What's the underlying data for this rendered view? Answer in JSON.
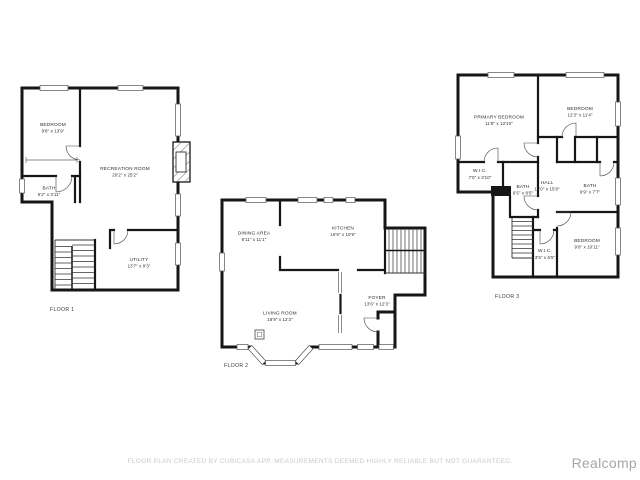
{
  "floors": [
    {
      "label": "FLOOR 1",
      "rooms": [
        {
          "name": "BEDROOM",
          "dims": "9'8\" x 13'9\""
        },
        {
          "name": "RECREATION ROOM",
          "dims": "20'2\" x 25'2\""
        },
        {
          "name": "BATH",
          "dims": "6'2\" x 3'11\""
        },
        {
          "name": "UTILITY",
          "dims": "13'7\" x 9'3\""
        }
      ]
    },
    {
      "label": "FLOOR 2",
      "rooms": [
        {
          "name": "DINING AREA",
          "dims": "8'11\" x 11'1\""
        },
        {
          "name": "KITCHEN",
          "dims": "16'9\" x 10'9\""
        },
        {
          "name": "FOYER",
          "dims": "13'6\" x 12'3\""
        },
        {
          "name": "LIVING ROOM",
          "dims": "18'9\" x 12'3\""
        }
      ]
    },
    {
      "label": "FLOOR 3",
      "rooms": [
        {
          "name": "PRIMARY BEDROOM",
          "dims": "11'8\" x 13'10\""
        },
        {
          "name": "BEDROOM",
          "dims": "12'3\" x 11'4\""
        },
        {
          "name": "W.I.C.",
          "dims": "7'0\" x 3'10\""
        },
        {
          "name": "BATH",
          "dims": "6'5\" x 8'5\""
        },
        {
          "name": "HALL",
          "dims": "10'0\" x 15'8\""
        },
        {
          "name": "BATH",
          "dims": "9'9\" x 7'7\""
        },
        {
          "name": "BEDROOM",
          "dims": "9'9\" x 10'11\""
        },
        {
          "name": "W.I.C.",
          "dims": "3'5\" x 6'5\""
        }
      ]
    }
  ],
  "footer": {
    "disclaimer": "FLOOR PLAN CREATED BY CUBICASA APP. MEASUREMENTS DEEMED HIGHLY RELIABLE BUT NOT GUARANTEED.",
    "brand": "Realcomp"
  },
  "colors": {
    "wall": "#161616",
    "label_text": "#2d2d2d",
    "disclaimer_text": "#c9c9c9",
    "brand_text": "#a6a6a6",
    "background": "#ffffff"
  }
}
